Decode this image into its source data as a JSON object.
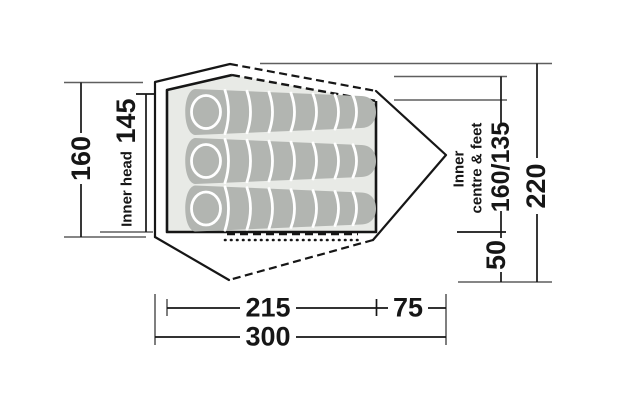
{
  "figure": {
    "title": "tent floor plan with dimensions",
    "background": "#ffffff",
    "line_color": "#161616",
    "extension_line_color": "#5f5f5f",
    "inner_fill": "#e8eae6",
    "bag_fill": "#b2b5b1",
    "rib_color": "#ffffff"
  },
  "dimensions": {
    "left_total": "160",
    "inner_head_label": "Inner head",
    "inner_head_value": "145",
    "right_label_line1": "Inner",
    "right_label_line2": "centre & feet",
    "right_inner_value": "160/135",
    "vestibule_depth": "50",
    "right_total": "220",
    "bottom_inner": "215",
    "bottom_vestibule": "75",
    "bottom_total": "300"
  }
}
